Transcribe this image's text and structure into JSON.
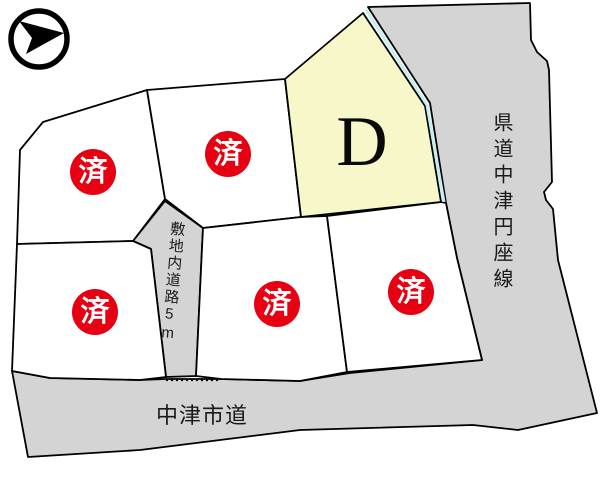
{
  "compass": {
    "icon": "north-arrow-icon"
  },
  "lots": {
    "d": {
      "label": "D",
      "fill": "#f7f7c9",
      "status": "available"
    },
    "sold": [
      {
        "id": "upper-left",
        "badge": "済"
      },
      {
        "id": "upper-middle",
        "badge": "済"
      },
      {
        "id": "lower-left",
        "badge": "済"
      },
      {
        "id": "lower-middle",
        "badge": "済"
      },
      {
        "id": "lower-right",
        "badge": "済"
      }
    ]
  },
  "roads": {
    "prefectural": {
      "label": "県道中津円座線"
    },
    "internal": {
      "label": "敷地内道路5m"
    },
    "city": {
      "label": "中津市道"
    }
  },
  "colors": {
    "road_fill": "#d4d4d4",
    "lot_fill": "#ffffff",
    "lot_d_fill": "#f7f7c9",
    "sold_badge": "#e60012",
    "badge_text": "#ffffff",
    "boundary_line": "#000000",
    "water_edge_line": "#c5eef0"
  }
}
